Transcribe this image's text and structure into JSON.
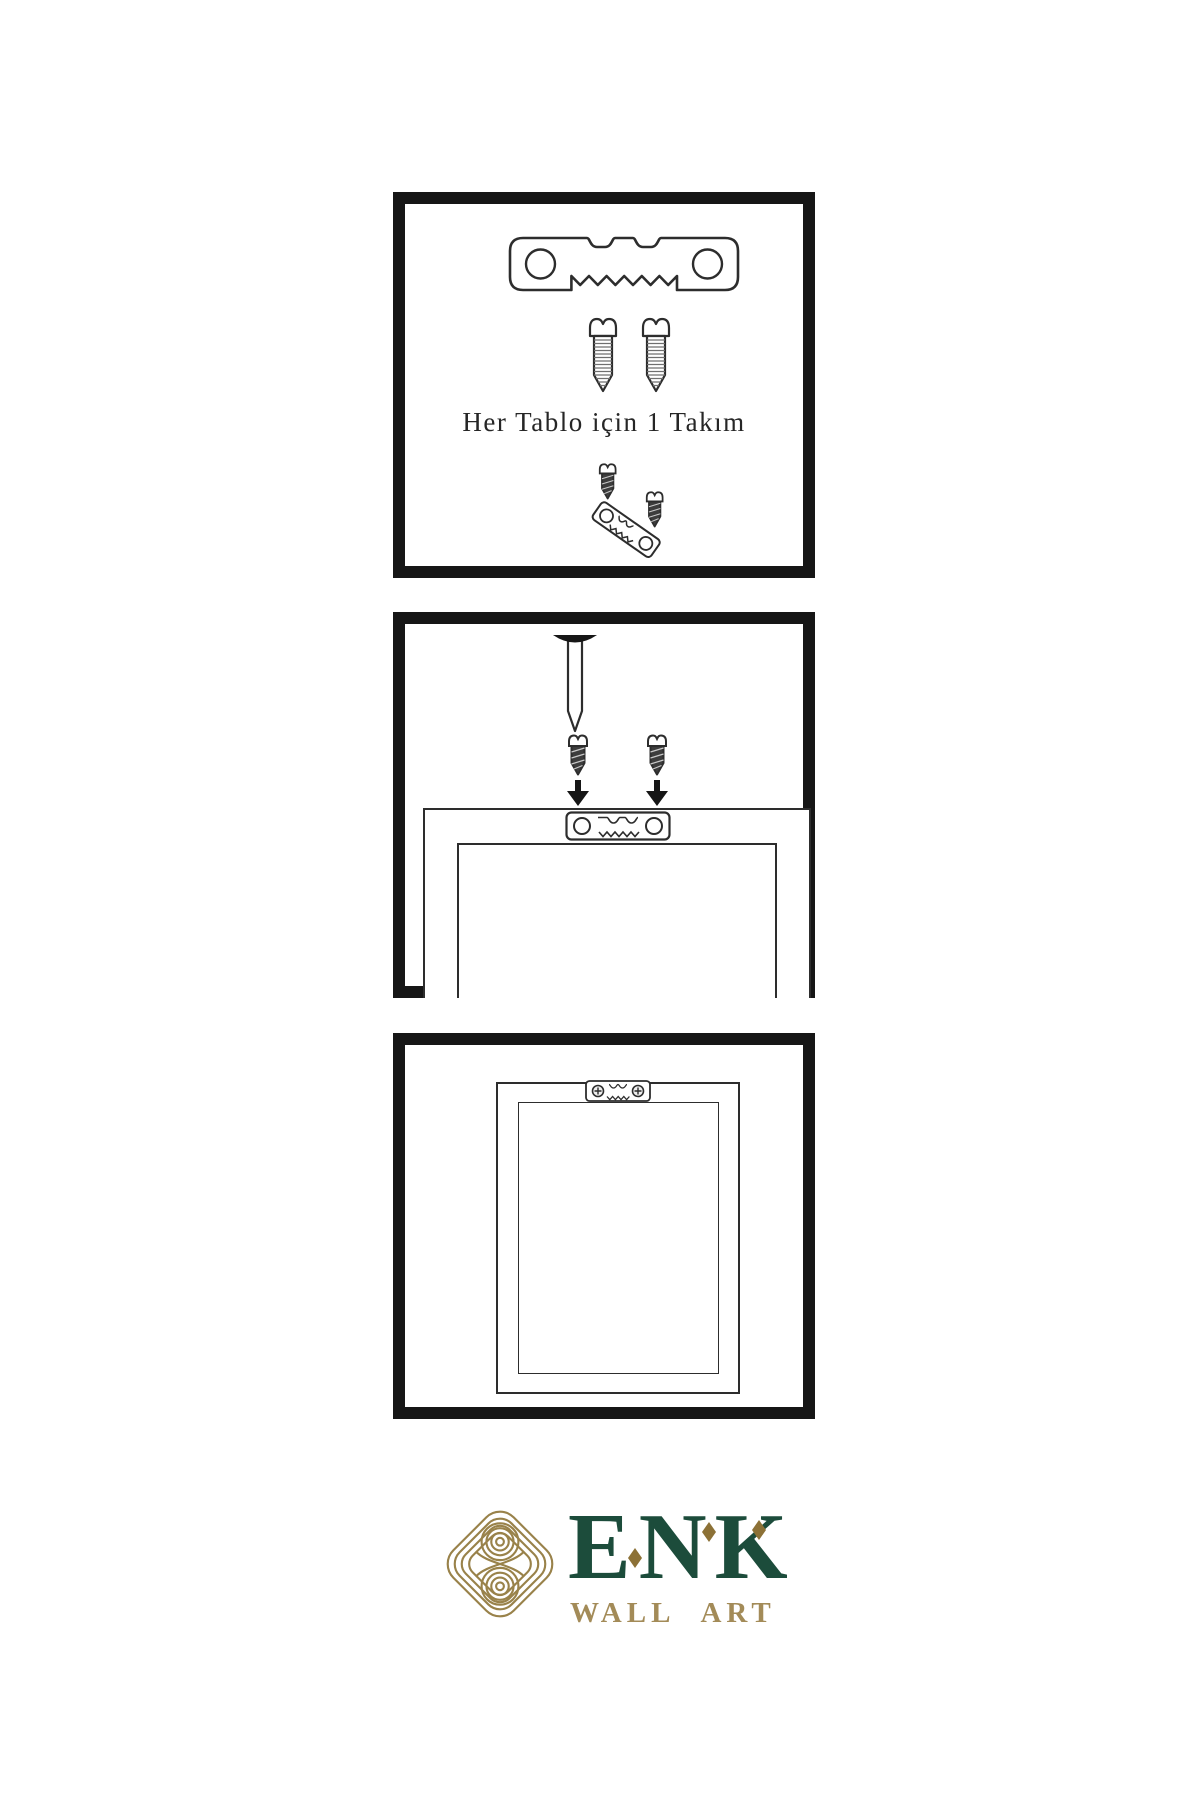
{
  "background": "#ffffff",
  "colors": {
    "panel_border": "#161616",
    "line_art": "#2d2d2d",
    "screw_dark_fill": "#3d3d3d",
    "brand_green": "#1c4c3b",
    "brand_gold": "#99824a",
    "brand_gold_dark": "#8c7136",
    "brand_gold_text": "#a38b58"
  },
  "panels": {
    "kit": {
      "caption": "Her Tablo için 1 Takım",
      "icons": [
        "sawtooth-hanger-icon",
        "screw-icon",
        "screw-icon",
        "screw-dark-icon",
        "sawtooth-hanger-tilted-icon",
        "screw-dark-icon"
      ]
    },
    "mounting": {
      "icons": [
        "nail-icon",
        "screw-dark-icon",
        "screw-dark-icon",
        "arrow-down-icon",
        "arrow-down-icon",
        "hanger-plate-icon",
        "frame-back-icon"
      ]
    },
    "hung": {
      "icons": [
        "hanger-mounted-icon",
        "frame-front-icon"
      ]
    }
  },
  "logo": {
    "brand": "ENK",
    "subtitle": "WALL ART",
    "icons": [
      "knot-icon",
      "diamond-icon",
      "diamond-icon",
      "diamond-icon"
    ]
  }
}
